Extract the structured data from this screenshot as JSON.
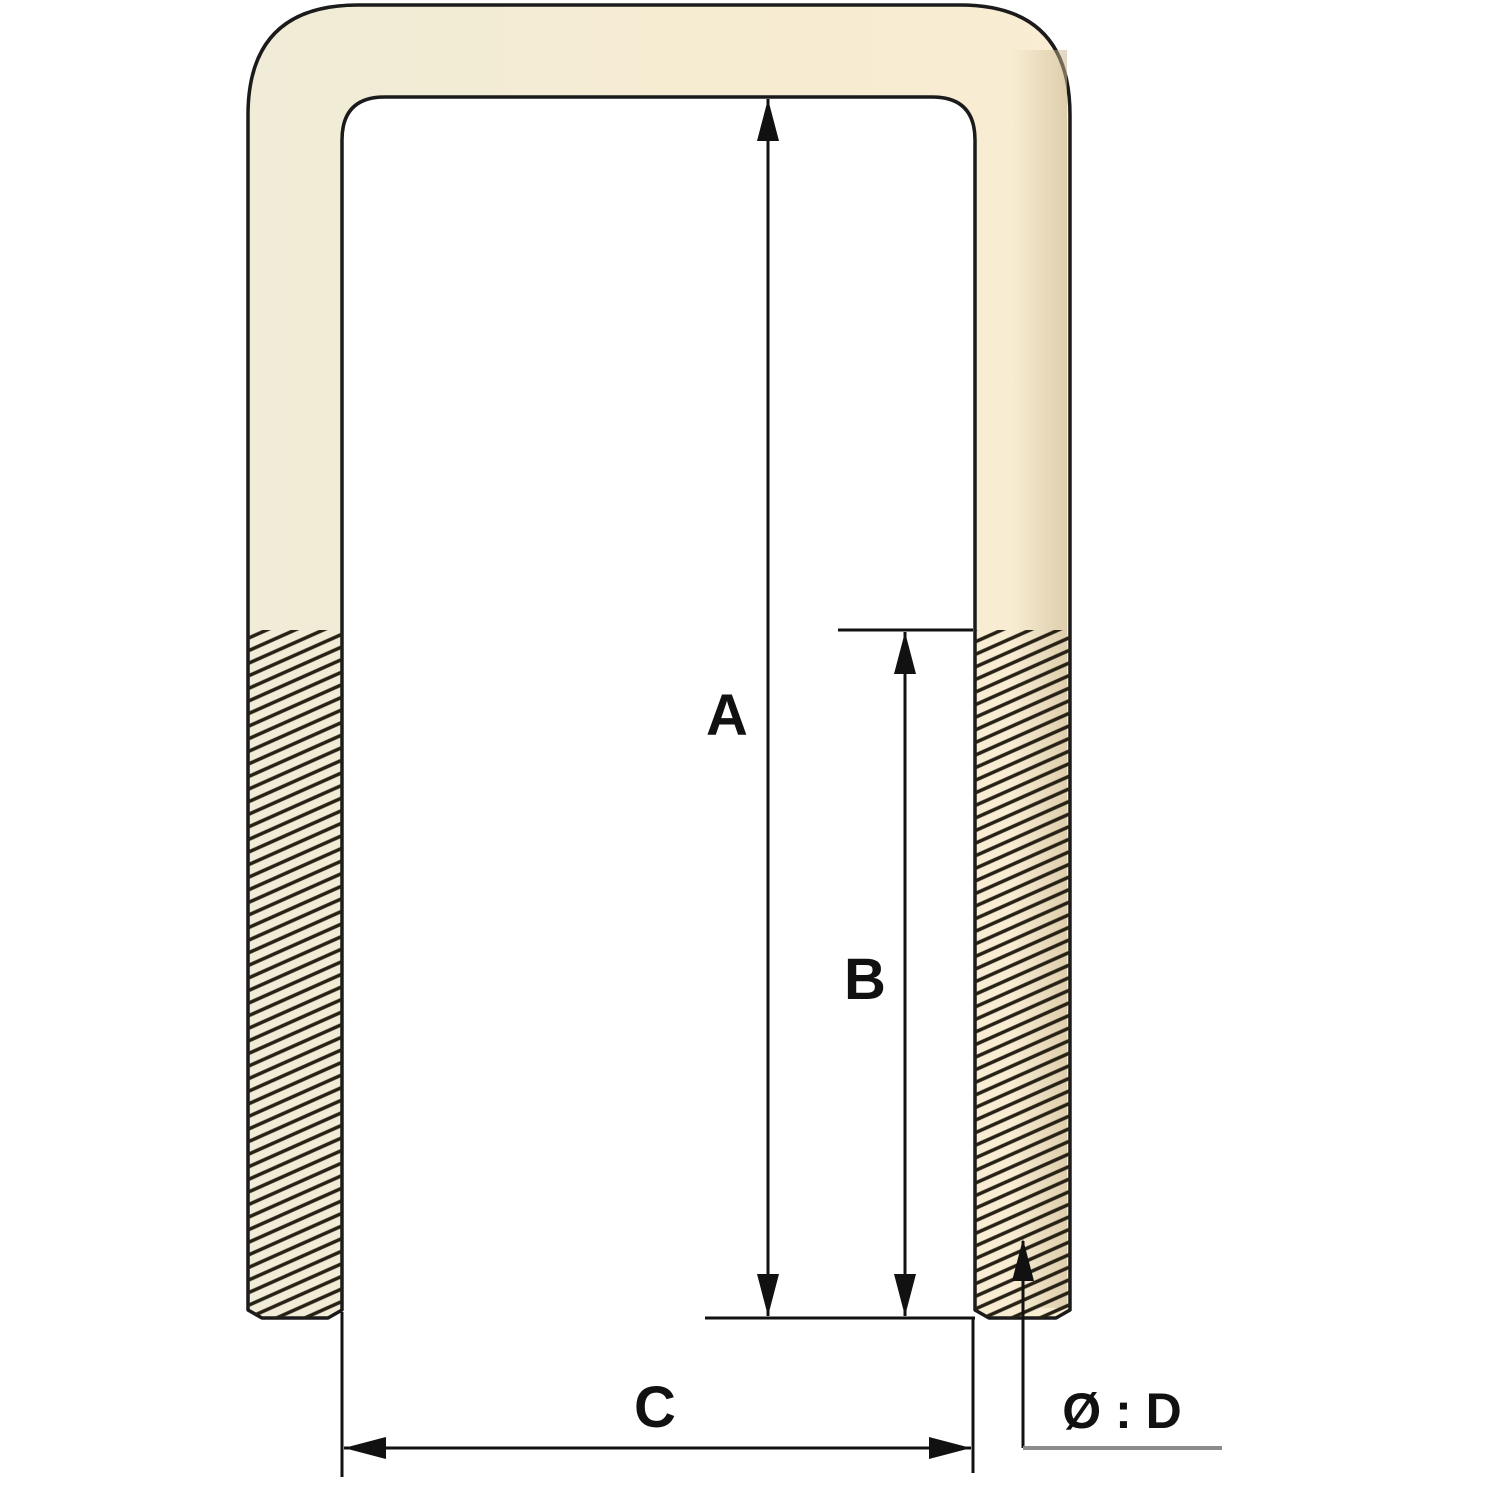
{
  "diagram": {
    "part_labels": {
      "inner_length": "A",
      "thread_length": "B",
      "inner_width": "C",
      "diameter": "Ø : D"
    },
    "colors": {
      "background": "#ffffff",
      "body_left": "#f0ecd7",
      "body_mid": "#f6ecd2",
      "body_right": "#f9edd3",
      "right_edge_shade": "#c8b58e",
      "outline": "#1b1b1b",
      "dimension": "#111111",
      "hatch": "#262015",
      "underline": "#8c8c8c"
    }
  }
}
